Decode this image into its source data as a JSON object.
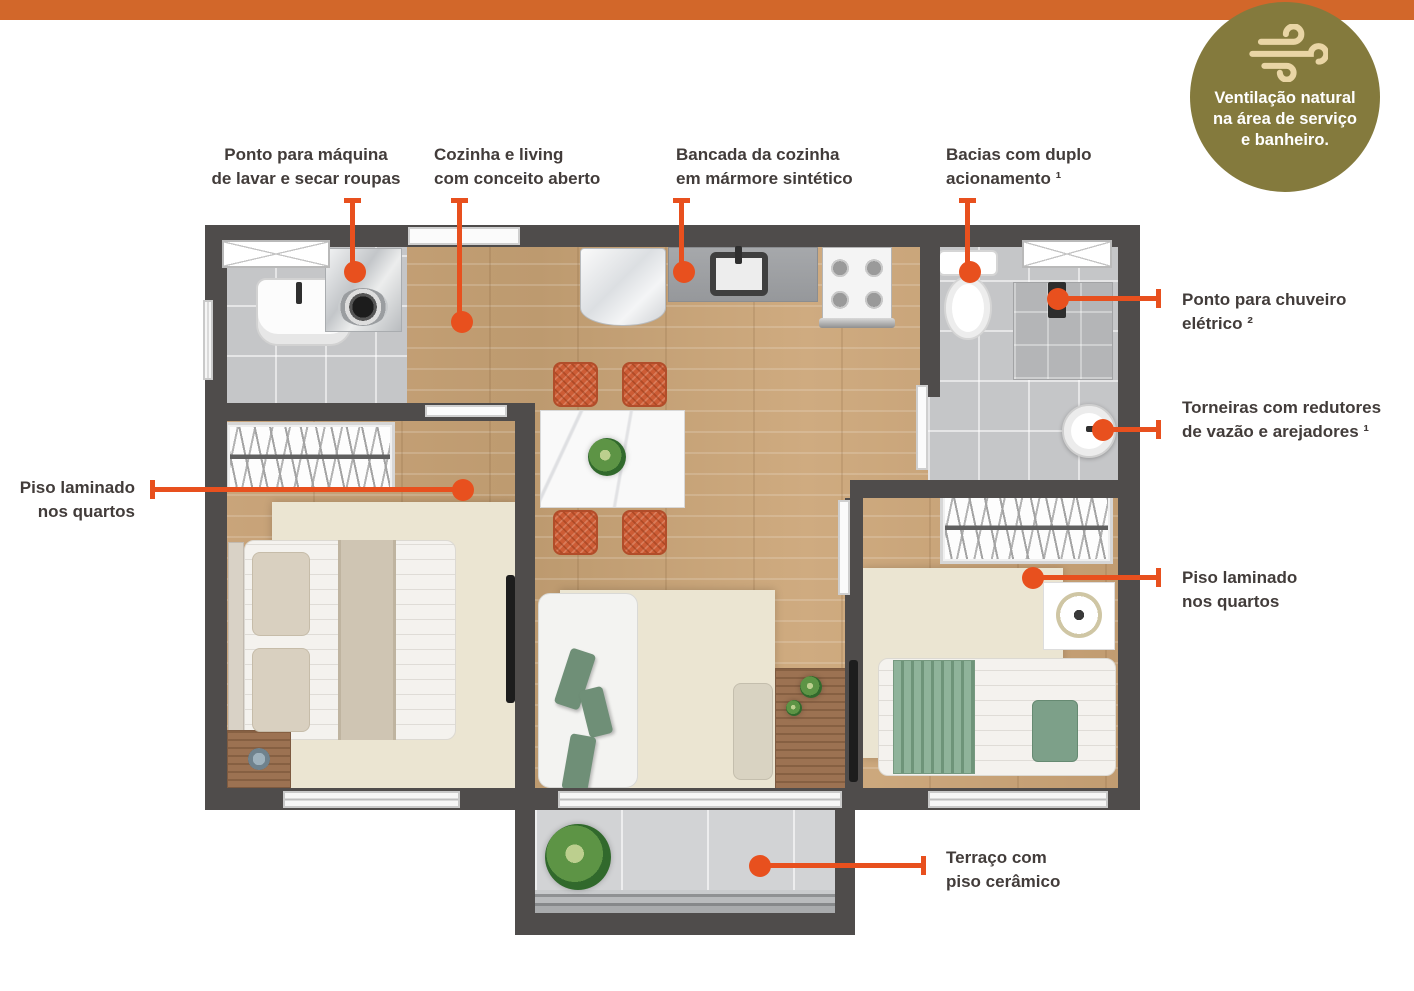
{
  "top_bar": {
    "color": "#d2672a"
  },
  "badge": {
    "bg_color": "#847a3d",
    "icon": "wind-icon",
    "icon_color": "#e9d5a5",
    "lines": [
      "Ventilação natural",
      "na área de serviço",
      "e banheiro."
    ]
  },
  "accent_color": "#e8501e",
  "callouts": [
    {
      "id": "washer-point",
      "lines": [
        "Ponto para máquina",
        "de lavar e secar roupas"
      ]
    },
    {
      "id": "open-kitchen",
      "lines": [
        "Cozinha e living",
        "com conceito aberto"
      ]
    },
    {
      "id": "countertop",
      "lines": [
        "Bancada da cozinha",
        "em mármore sintético"
      ]
    },
    {
      "id": "dual-flush",
      "lines": [
        "Bacias com duplo",
        "acionamento ¹"
      ]
    },
    {
      "id": "shower-point",
      "lines": [
        "Ponto para chuveiro",
        "elétrico ²"
      ]
    },
    {
      "id": "faucets",
      "lines": [
        "Torneiras com redutores",
        "de vazão e arejadores ¹"
      ]
    },
    {
      "id": "laminate-left",
      "lines": [
        "Piso laminado",
        "nos quartos"
      ]
    },
    {
      "id": "laminate-right",
      "lines": [
        "Piso laminado",
        "nos quartos"
      ]
    },
    {
      "id": "terrace",
      "lines": [
        "Terraço com",
        "piso cerâmico"
      ]
    }
  ],
  "floorplan": {
    "wall_color": "#4f4c4b",
    "wood_color": "#c7a178",
    "tile_color": "#c5c6c8",
    "rug_color": "#ebe5d2"
  }
}
